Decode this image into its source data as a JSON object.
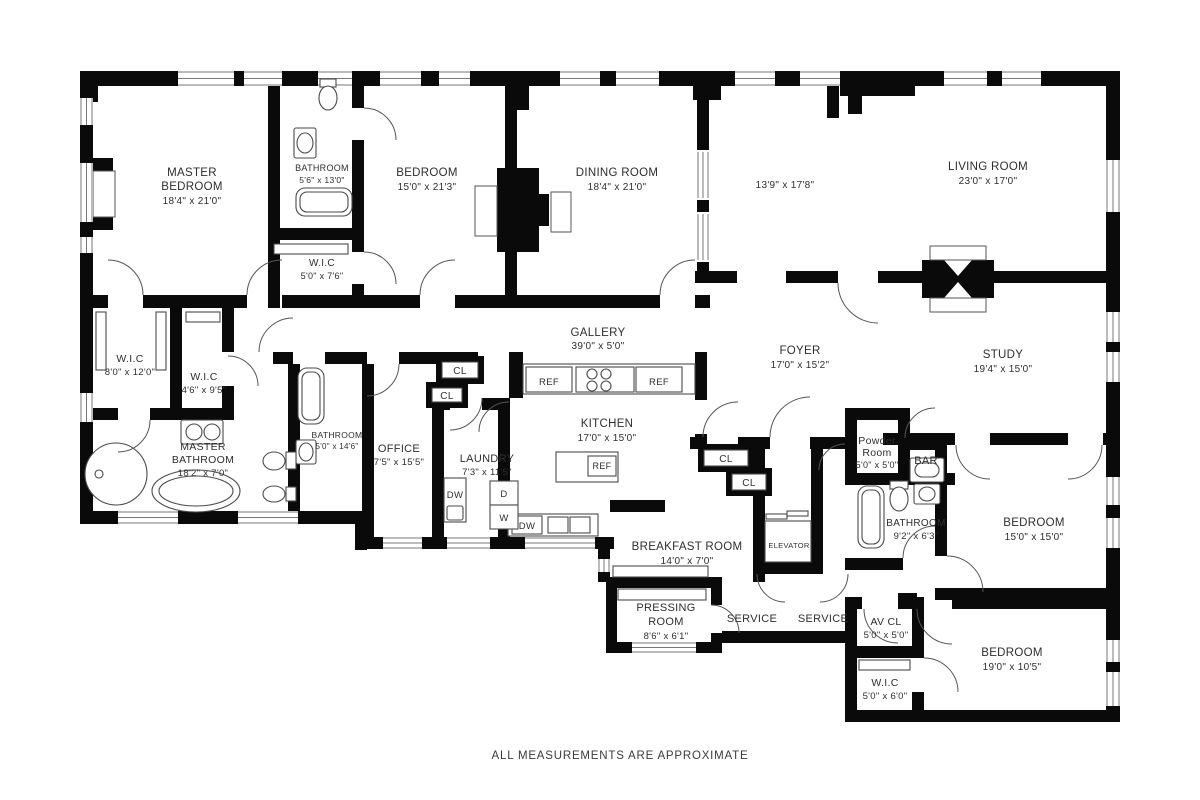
{
  "footer": "ALL MEASUREMENTS ARE APPROXIMATE",
  "plan": {
    "labels": [
      {
        "t": "MASTER",
        "x": 192,
        "y": 176,
        "fs": 11.5
      },
      {
        "t": "BEDROOM",
        "x": 192,
        "y": 190,
        "fs": 11.5
      },
      {
        "t": "18'4\" x 21'0\"",
        "x": 192,
        "y": 204,
        "fs": 10
      },
      {
        "t": "BATHROOM",
        "x": 322,
        "y": 171,
        "fs": 9
      },
      {
        "t": "5'6\" x 13'0\"",
        "x": 322,
        "y": 183,
        "fs": 8.5
      },
      {
        "t": "BEDROOM",
        "x": 427,
        "y": 176,
        "fs": 11.5
      },
      {
        "t": "15'0\" x 21'3\"",
        "x": 427,
        "y": 190,
        "fs": 10
      },
      {
        "t": "DINING ROOM",
        "x": 617,
        "y": 176,
        "fs": 11.5
      },
      {
        "t": "18'4\" x 21'0\"",
        "x": 617,
        "y": 190,
        "fs": 10
      },
      {
        "t": "13'9\" x 17'8\"",
        "x": 785,
        "y": 188,
        "fs": 10
      },
      {
        "t": "LIVING ROOM",
        "x": 988,
        "y": 170,
        "fs": 11.5
      },
      {
        "t": "23'0\" x 17'0\"",
        "x": 988,
        "y": 184,
        "fs": 10
      },
      {
        "t": "W.I.C",
        "x": 322,
        "y": 266,
        "fs": 10
      },
      {
        "t": "5'0\" x 7'6\"",
        "x": 322,
        "y": 279,
        "fs": 9
      },
      {
        "t": "W.I.C",
        "x": 130,
        "y": 362,
        "fs": 10.5
      },
      {
        "t": "8'0\" x 12'0\"",
        "x": 130,
        "y": 375,
        "fs": 9.5
      },
      {
        "t": "W.I.C",
        "x": 204,
        "y": 380,
        "fs": 10.5
      },
      {
        "t": "4'6\" x 9'5\"",
        "x": 204,
        "y": 393,
        "fs": 9.5
      },
      {
        "t": "GALLERY",
        "x": 598,
        "y": 336,
        "fs": 11.5
      },
      {
        "t": "39'0\" x 5'0\"",
        "x": 598,
        "y": 349,
        "fs": 10
      },
      {
        "t": "MASTER",
        "x": 203,
        "y": 450,
        "fs": 10.5
      },
      {
        "t": "BATHROOM",
        "x": 203,
        "y": 463,
        "fs": 10.5
      },
      {
        "t": "18'2\" x 7'0\"",
        "x": 203,
        "y": 476,
        "fs": 9.5
      },
      {
        "t": "BATHROOM",
        "x": 337,
        "y": 438,
        "fs": 8.5
      },
      {
        "t": "5'0\" x 14'6\"",
        "x": 337,
        "y": 449,
        "fs": 8
      },
      {
        "t": "OFFICE",
        "x": 399,
        "y": 452,
        "fs": 11
      },
      {
        "t": "7'5\" x 15'5\"",
        "x": 399,
        "y": 465,
        "fs": 9.5
      },
      {
        "t": "LAUNDRY",
        "x": 487,
        "y": 462,
        "fs": 11
      },
      {
        "t": "7'3\" x 11'5\"",
        "x": 487,
        "y": 475,
        "fs": 9.5
      },
      {
        "t": "KITCHEN",
        "x": 607,
        "y": 427,
        "fs": 11.5
      },
      {
        "t": "17'0\" x 15'0\"",
        "x": 607,
        "y": 441,
        "fs": 10
      },
      {
        "t": "FOYER",
        "x": 800,
        "y": 354,
        "fs": 11.5
      },
      {
        "t": "17'0\" x 15'2\"",
        "x": 800,
        "y": 368,
        "fs": 10
      },
      {
        "t": "STUDY",
        "x": 1003,
        "y": 358,
        "fs": 11.5
      },
      {
        "t": "19'4\" x 15'0\"",
        "x": 1003,
        "y": 372,
        "fs": 10
      },
      {
        "t": "Powder",
        "x": 877,
        "y": 444,
        "fs": 10.5
      },
      {
        "t": "Room",
        "x": 877,
        "y": 456,
        "fs": 10.5
      },
      {
        "t": "5'0\" x 5'0\"",
        "x": 877,
        "y": 468,
        "fs": 9
      },
      {
        "t": "BAR",
        "x": 926,
        "y": 464,
        "fs": 11
      },
      {
        "t": "BATHROOM",
        "x": 916,
        "y": 526,
        "fs": 10
      },
      {
        "t": "9'2\" x 6'3\"",
        "x": 916,
        "y": 539,
        "fs": 9.5
      },
      {
        "t": "BEDROOM",
        "x": 1034,
        "y": 526,
        "fs": 11.5
      },
      {
        "t": "15'0\" x 15'0\"",
        "x": 1034,
        "y": 540,
        "fs": 10
      },
      {
        "t": "BREAKFAST ROOM",
        "x": 687,
        "y": 550,
        "fs": 11.5
      },
      {
        "t": "14'0\" x 7'0\"",
        "x": 687,
        "y": 564,
        "fs": 10
      },
      {
        "t": "ELEVATOR",
        "x": 789,
        "y": 548,
        "fs": 7.5
      },
      {
        "t": "PRESSING",
        "x": 666,
        "y": 611,
        "fs": 11
      },
      {
        "t": "ROOM",
        "x": 666,
        "y": 625,
        "fs": 11
      },
      {
        "t": "8'6\" x 6'1\"",
        "x": 666,
        "y": 639,
        "fs": 9.5
      },
      {
        "t": "SERVICE",
        "x": 752,
        "y": 622,
        "fs": 11
      },
      {
        "t": "SERVICE",
        "x": 823,
        "y": 622,
        "fs": 11
      },
      {
        "t": "AV CL",
        "x": 886,
        "y": 625,
        "fs": 10.5
      },
      {
        "t": "5'0\" x 5'0\"",
        "x": 886,
        "y": 638,
        "fs": 9.5
      },
      {
        "t": "W.I.C",
        "x": 885,
        "y": 686,
        "fs": 10.5
      },
      {
        "t": "5'0\" x 6'0\"",
        "x": 885,
        "y": 699,
        "fs": 9.5
      },
      {
        "t": "BEDROOM",
        "x": 1012,
        "y": 656,
        "fs": 11.5
      },
      {
        "t": "19'0\" x 10'5\"",
        "x": 1012,
        "y": 670,
        "fs": 10
      },
      {
        "t": "REF",
        "x": 549,
        "y": 385,
        "fs": 9.5
      },
      {
        "t": "REF",
        "x": 659,
        "y": 385,
        "fs": 9.5
      },
      {
        "t": "REF",
        "x": 602,
        "y": 469,
        "fs": 9
      },
      {
        "t": "DW",
        "x": 455,
        "y": 498,
        "fs": 9.5
      },
      {
        "t": "D",
        "x": 504,
        "y": 497,
        "fs": 9.5
      },
      {
        "t": "W",
        "x": 504,
        "y": 521,
        "fs": 9.5
      },
      {
        "t": "DW",
        "x": 527,
        "y": 529,
        "fs": 9.5
      },
      {
        "t": "CL",
        "x": 460,
        "y": 374,
        "fs": 10
      },
      {
        "t": "CL",
        "x": 447,
        "y": 399,
        "fs": 10
      },
      {
        "t": "CL",
        "x": 726,
        "y": 462,
        "fs": 10
      },
      {
        "t": "CL",
        "x": 749,
        "y": 486,
        "fs": 10
      }
    ]
  }
}
